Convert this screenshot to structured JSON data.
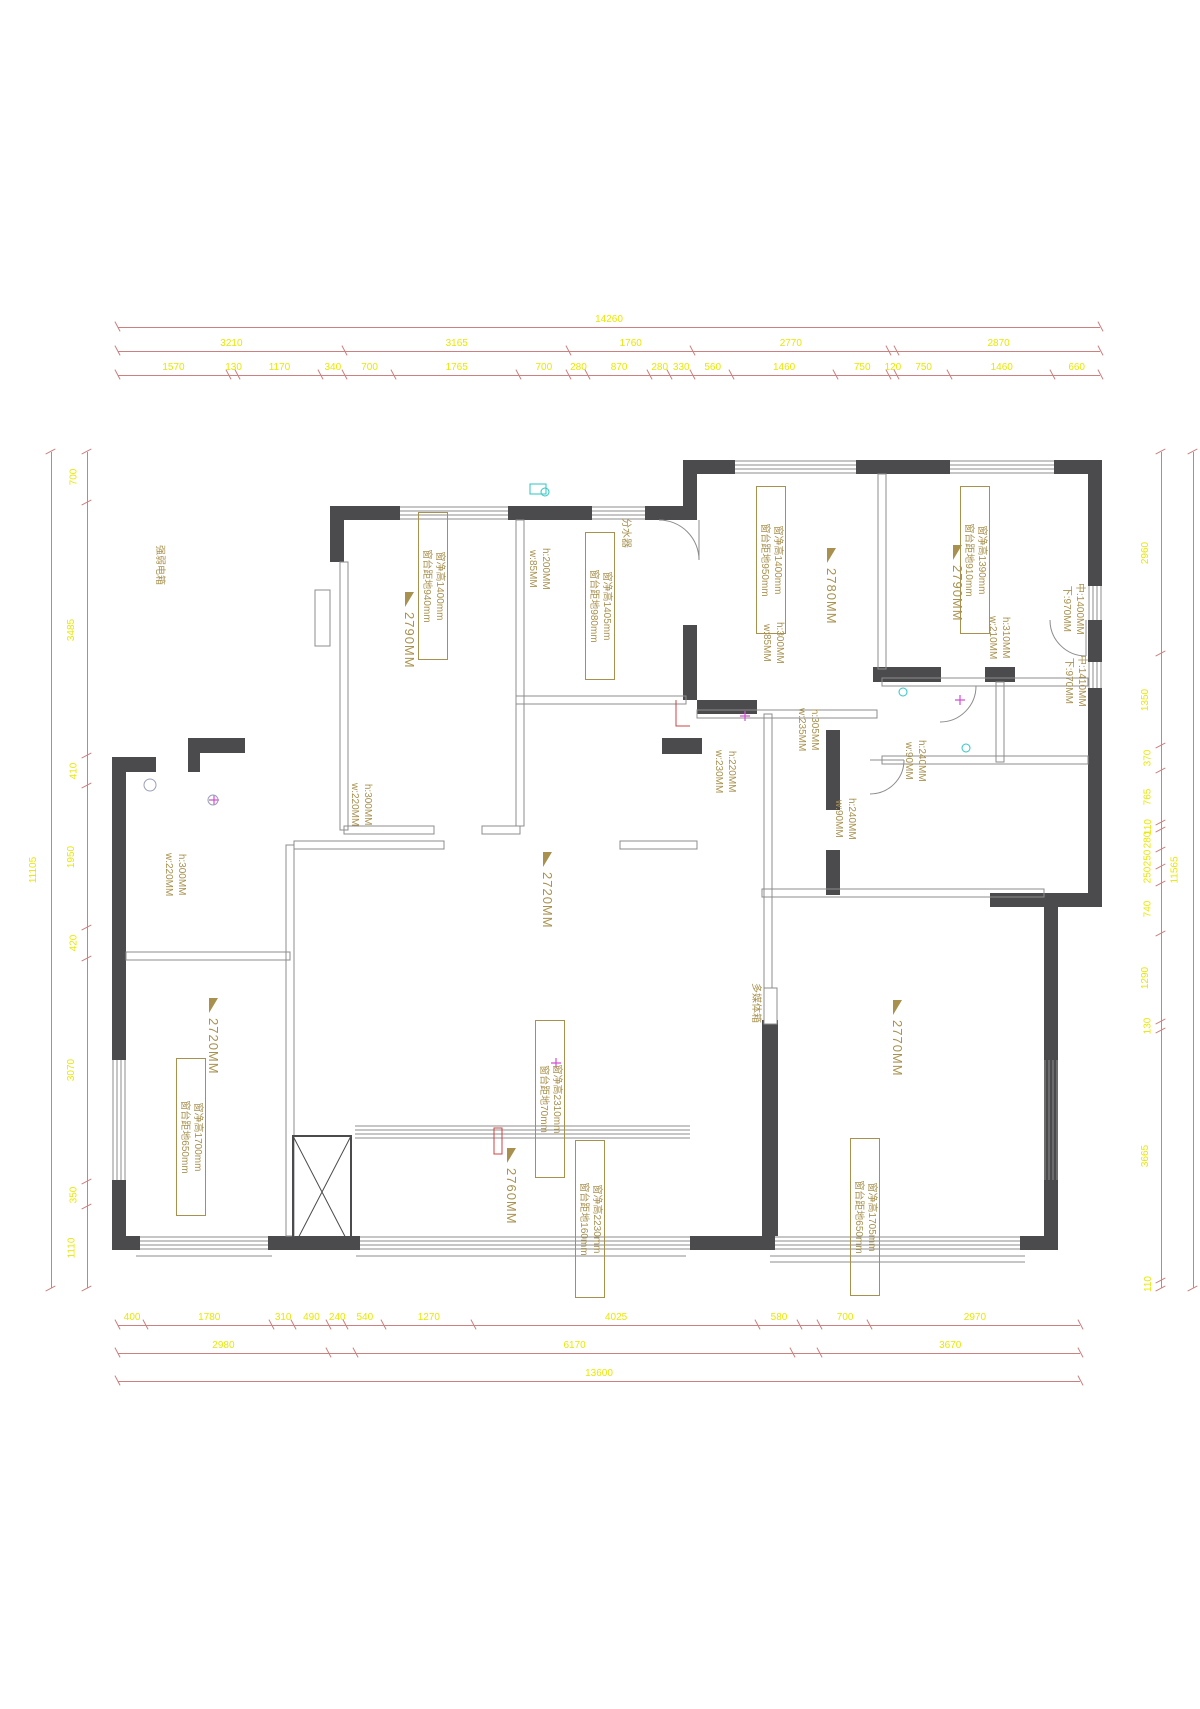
{
  "document": {
    "type": "residential floor plan (CAD measurement drawing)"
  },
  "colors": {
    "wall": "#4b4b4d",
    "thin": "#8c8c8c",
    "dim": "#cc8080",
    "dimtext": "#e8e800",
    "note": "#a8914e",
    "cyan": "#2ec6c6",
    "magenta": "#d24fd2",
    "red": "#cc4444"
  },
  "dimensions": {
    "rows": [
      {
        "id": "top-overall",
        "x": 118,
        "y": 312,
        "length": 982,
        "vertical": false,
        "values": [
          {
            "label": "14260",
            "size": 14260
          }
        ]
      },
      {
        "id": "top-row2",
        "x": 118,
        "y": 336,
        "length": 982,
        "vertical": false,
        "values": [
          {
            "label": "3210",
            "size": 3210
          },
          {
            "label": "3165",
            "size": 3165
          },
          {
            "label": "1760",
            "size": 1760
          },
          {
            "label": "2770",
            "size": 2770
          },
          {
            "label": "",
            "size": 120
          },
          {
            "label": "2870",
            "size": 2870
          }
        ]
      },
      {
        "id": "top-row3",
        "x": 118,
        "y": 360,
        "length": 982,
        "vertical": false,
        "values": [
          {
            "label": "1570",
            "size": 1570
          },
          {
            "label": "130",
            "size": 130
          },
          {
            "label": "1170",
            "size": 1170
          },
          {
            "label": "340",
            "size": 340
          },
          {
            "label": "700",
            "size": 700
          },
          {
            "label": "1765",
            "size": 1765
          },
          {
            "label": "700",
            "size": 700
          },
          {
            "label": "280",
            "size": 280
          },
          {
            "label": "870",
            "size": 870
          },
          {
            "label": "280",
            "size": 280
          },
          {
            "label": "330",
            "size": 330
          },
          {
            "label": "560",
            "size": 560
          },
          {
            "label": "1460",
            "size": 1460
          },
          {
            "label": "750",
            "size": 750
          },
          {
            "label": "120",
            "size": 120
          },
          {
            "label": "750",
            "size": 750
          },
          {
            "label": "1460",
            "size": 1460
          },
          {
            "label": "660",
            "size": 660
          }
        ]
      },
      {
        "id": "bottom-row1",
        "x": 118,
        "y": 1310,
        "length": 962,
        "vertical": false,
        "values": [
          {
            "label": "400",
            "size": 400
          },
          {
            "label": "1780",
            "size": 1780
          },
          {
            "label": "310",
            "size": 310
          },
          {
            "label": "490",
            "size": 490
          },
          {
            "label": "240",
            "size": 240
          },
          {
            "label": "540",
            "size": 540
          },
          {
            "label": "1270",
            "size": 1270
          },
          {
            "label": "4025",
            "size": 4025
          },
          {
            "label": "580",
            "size": 580
          },
          {
            "label": "",
            "size": 295
          },
          {
            "label": "700",
            "size": 700
          },
          {
            "label": "2970",
            "size": 2970
          }
        ]
      },
      {
        "id": "bottom-row2",
        "x": 118,
        "y": 1338,
        "length": 962,
        "vertical": false,
        "values": [
          {
            "label": "2980",
            "size": 2980
          },
          {
            "label": "",
            "size": 390
          },
          {
            "label": "6170",
            "size": 6170
          },
          {
            "label": "",
            "size": 390
          },
          {
            "label": "3670",
            "size": 3670
          }
        ]
      },
      {
        "id": "bottom-row3",
        "x": 118,
        "y": 1366,
        "length": 962,
        "vertical": false,
        "values": [
          {
            "label": "13600",
            "size": 13600
          }
        ]
      },
      {
        "id": "left-outer",
        "x": 36,
        "y": 452,
        "length": 836,
        "vertical": true,
        "values": [
          {
            "label": "11105",
            "size": 11105
          }
        ]
      },
      {
        "id": "left-inner",
        "x": 72,
        "y": 452,
        "length": 836,
        "vertical": true,
        "values": [
          {
            "label": "700",
            "size": 700
          },
          {
            "label": "3485",
            "size": 3485
          },
          {
            "label": "410",
            "size": 410
          },
          {
            "label": "1950",
            "size": 1950
          },
          {
            "label": "420",
            "size": 420
          },
          {
            "label": "3070",
            "size": 3070
          },
          {
            "label": "350",
            "size": 350
          },
          {
            "label": "1110",
            "size": 1110
          }
        ]
      },
      {
        "id": "right-inner",
        "x": 1146,
        "y": 452,
        "length": 836,
        "vertical": true,
        "values": [
          {
            "label": "2960",
            "size": 2960
          },
          {
            "label": "1350",
            "size": 1350
          },
          {
            "label": "370",
            "size": 370
          },
          {
            "label": "765",
            "size": 765
          },
          {
            "label": "110",
            "size": 110
          },
          {
            "label": "280",
            "size": 280
          },
          {
            "label": "250",
            "size": 250
          },
          {
            "label": "250",
            "size": 250
          },
          {
            "label": "740",
            "size": 740
          },
          {
            "label": "1290",
            "size": 1290
          },
          {
            "label": "130",
            "size": 130
          },
          {
            "label": "3665",
            "size": 3665
          },
          {
            "label": "110",
            "size": 110
          }
        ]
      },
      {
        "id": "right-outer",
        "x": 1178,
        "y": 452,
        "length": 836,
        "vertical": true,
        "values": [
          {
            "label": "11565",
            "size": 11565
          }
        ]
      }
    ]
  },
  "ceiling_labels": [
    {
      "text": "2790MM",
      "x": 398,
      "y": 592,
      "h": 165
    },
    {
      "text": "2780MM",
      "x": 820,
      "y": 548,
      "h": 150
    },
    {
      "text": "2790MM",
      "x": 946,
      "y": 545,
      "h": 150
    },
    {
      "text": "2720MM",
      "x": 536,
      "y": 852,
      "h": 165
    },
    {
      "text": "2720MM",
      "x": 202,
      "y": 998,
      "h": 165
    },
    {
      "text": "2760MM",
      "x": 500,
      "y": 1148,
      "h": 150
    },
    {
      "text": "2770MM",
      "x": 886,
      "y": 1000,
      "h": 160
    }
  ],
  "window_notes": [
    {
      "line1": "窗净高1400mm",
      "line2": "窗台距地940mm",
      "x": 418,
      "y": 512,
      "h": 140
    },
    {
      "line1": "窗净高1405mm",
      "line2": "窗台距地980mm",
      "x": 585,
      "y": 532,
      "h": 140
    },
    {
      "line1": "窗净高1400mm",
      "line2": "窗台距地950mm",
      "x": 756,
      "y": 486,
      "h": 140
    },
    {
      "line1": "窗净高1390mm",
      "line2": "窗台距地910mm",
      "x": 960,
      "y": 486,
      "h": 140
    },
    {
      "line1": "窗净高1700mm",
      "line2": "窗台距地650mm",
      "x": 176,
      "y": 1058,
      "h": 150
    },
    {
      "line1": "窗净高2310mm",
      "line2": "窗台距地70mm",
      "x": 535,
      "y": 1020,
      "h": 150
    },
    {
      "line1": "窗净高2230mm",
      "line2": "窗台距地160mm",
      "x": 575,
      "y": 1140,
      "h": 150
    },
    {
      "line1": "窗净高1705mm",
      "line2": "窗台距地650mm",
      "x": 850,
      "y": 1138,
      "h": 150
    }
  ],
  "size_notes": [
    {
      "line1": "h:200MM",
      "line2": "w:85MM",
      "x": 524,
      "y": 548
    },
    {
      "line1": "h:300MM",
      "line2": "w:85MM",
      "x": 758,
      "y": 622
    },
    {
      "line1": "h:310MM",
      "line2": "w:210MM",
      "x": 984,
      "y": 616
    },
    {
      "line1": "h:305MM",
      "line2": "w:235MM",
      "x": 793,
      "y": 708
    },
    {
      "line1": "h:220MM",
      "line2": "w:230MM",
      "x": 710,
      "y": 750
    },
    {
      "line1": "h:300MM",
      "line2": "w:220MM",
      "x": 346,
      "y": 783
    },
    {
      "line1": "h:300MM",
      "line2": "w:220MM",
      "x": 160,
      "y": 853
    },
    {
      "line1": "h:240MM",
      "line2": "w:90MM",
      "x": 830,
      "y": 798
    },
    {
      "line1": "h:240MM",
      "line2": "w:90MM",
      "x": 900,
      "y": 740
    },
    {
      "line1": "中:1400MM",
      "line2": "下:970MM",
      "x": 1058,
      "y": 583
    },
    {
      "line1": "中:1410MM",
      "line2": "下:970MM",
      "x": 1060,
      "y": 655
    }
  ],
  "equipment_labels": [
    {
      "text": "强弱电箱",
      "x": 152,
      "y": 545
    },
    {
      "text": "分水器",
      "x": 618,
      "y": 518
    },
    {
      "text": "多媒体箱",
      "x": 748,
      "y": 983
    }
  ]
}
